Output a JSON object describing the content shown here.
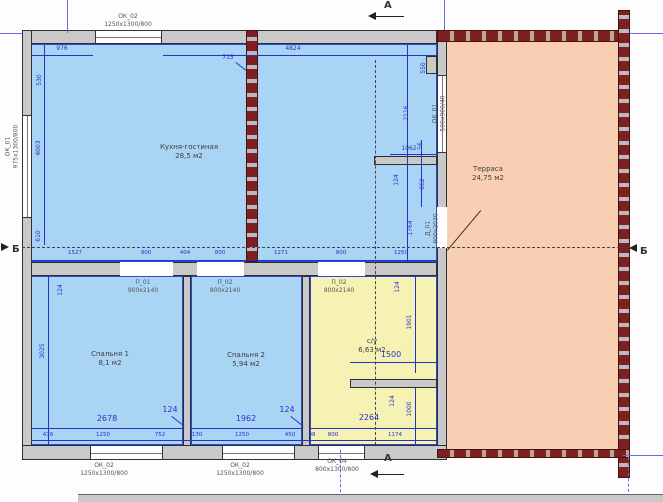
{
  "colors": {
    "room_blue": "#aad4f3",
    "room_yellow": "#f6f2b4",
    "terrace_salmon": "#f8cfb2",
    "wall_grey": "#c9c9c9",
    "brick_red": "#7e2020",
    "dim_blue": "#2233cc"
  },
  "rooms": {
    "kitchen": {
      "name": "Кухня-гостиная",
      "area": "28,5 м2"
    },
    "terrace": {
      "name": "Терраса",
      "area": "24,75 м2"
    },
    "bedroom1": {
      "name": "Спальня 1",
      "area": "8,1 м2"
    },
    "bedroom2": {
      "name": "Спальня 2",
      "area": "5,94 м2"
    },
    "bathroom": {
      "name": "с/у",
      "area": "6,63 м2"
    }
  },
  "openings": {
    "ok02_top": {
      "mark": "ОК_02",
      "size": "1250х1300/800"
    },
    "ok01_left": {
      "mark": "ОК_01",
      "size": "975х1300/800"
    },
    "ok01_right": {
      "mark": "ОК_01",
      "size": "500х900/40"
    },
    "d01": {
      "mark": "Д_01",
      "size": "900х2030"
    },
    "p01": {
      "mark": "П_01",
      "size": "900х2140"
    },
    "p02a": {
      "mark": "П_02",
      "size": "800х2140"
    },
    "p02b": {
      "mark": "П_02",
      "size": "800х2140"
    },
    "ok02_bottom1": {
      "mark": "ОК_02",
      "size": "1250х1300/800"
    },
    "ok02_bottom2": {
      "mark": "ОК_02",
      "size": "1250х1300/800"
    },
    "ok04": {
      "mark": "ОК_04",
      "size": "800х1300/800"
    }
  },
  "sections": {
    "a_top": "А",
    "a_bottom": "А",
    "b_left": "Б",
    "b_right": "Б"
  },
  "dims": {
    "top_left": "976",
    "top_right": "4824",
    "column": "715",
    "left_top": "530",
    "left_mid": "4003",
    "left_bottom": "610",
    "kr_550": "550",
    "kr_2116": "2116",
    "kr_1062": "1062",
    "kr_56": "56",
    "kr_124": "124",
    "kr_662": "662",
    "kr_1764": "1764",
    "row": [
      "1527",
      "900",
      "404",
      "800",
      "1271",
      "800",
      "1250"
    ],
    "b1_w": "2678",
    "b2_w": "1962",
    "b_h": "3025",
    "lead_b1": "124",
    "lead_w1": "124",
    "lead_w2": "124",
    "bottom": [
      "476",
      "1250",
      "752",
      "130",
      "1250",
      "450",
      "98",
      "800",
      "1174"
    ],
    "bath_124a": "124",
    "bath_1901": "1901",
    "bath_1500": "1500",
    "bath_124b": "124",
    "bath_1000": "1000",
    "bath_2264": "2264"
  }
}
